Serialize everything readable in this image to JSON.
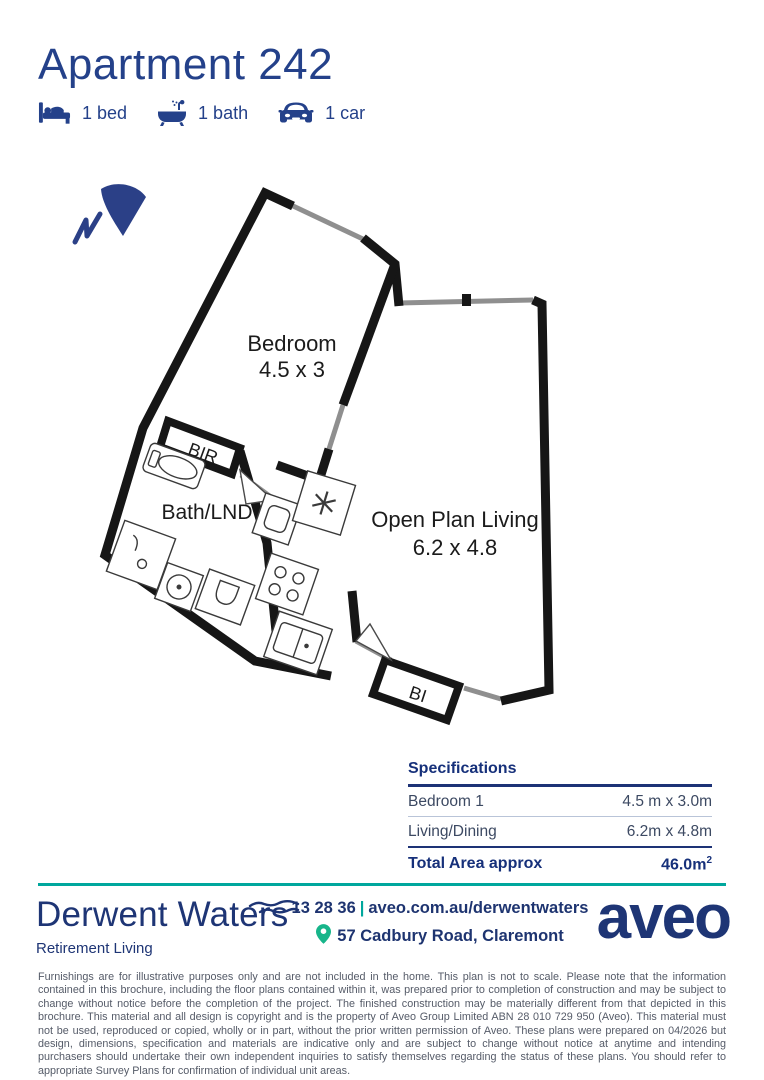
{
  "page": {
    "title": "Apartment 242"
  },
  "features": [
    {
      "icon": "bed-icon",
      "label": "1 bed"
    },
    {
      "icon": "bath-icon",
      "label": "1 bath"
    },
    {
      "icon": "car-icon",
      "label": "1 car"
    }
  ],
  "floorplan": {
    "north_icon": "north-arrow-icon",
    "bedroom": {
      "name": "Bedroom",
      "dims": "4.5 x 3"
    },
    "bath": {
      "name": "Bath/LND"
    },
    "living": {
      "name": "Open Plan Living",
      "dims": "6.2 x 4.8"
    },
    "robe_label": "BIR",
    "builtin_label": "BI",
    "wall_color": "#161616",
    "window_color": "#8f8f8f"
  },
  "specifications": {
    "heading": "Specifications",
    "rows": [
      {
        "label": "Bedroom 1",
        "value": "4.5 m x 3.0m"
      },
      {
        "label": "Living/Dining",
        "value": "6.2m x 4.8m"
      }
    ],
    "total": {
      "label": "Total Area approx",
      "value": "46.0m",
      "sup": "2"
    }
  },
  "footer": {
    "brand": "Derwent Waters",
    "brand_sub": "Retirement Living",
    "phone": "13 28 36",
    "separator": "|",
    "website": "aveo.com.au/derwentwaters",
    "address": "57 Cadbury Road, Claremont",
    "logo": "aveo",
    "wave_icon": "wave-icon",
    "pin_icon": "location-pin-icon"
  },
  "colors": {
    "navy": "#1e3575",
    "title_navy": "#24418a",
    "teal": "#00a79d",
    "pin_green": "#17b58a",
    "row_text": "#3c4962",
    "disclaimer_gray": "#555b68"
  },
  "disclaimer": "Furnishings are for illustrative purposes only and are not included in the home. This plan is not to scale. Please note that the information contained in this brochure, including the floor plans contained within it, was prepared prior to completion of construction and may be subject to change without notice before the completion of the project. The finished construction may be materially different from that depicted in this brochure. This material and all design is copyright and is the property of Aveo Group Limited ABN 28 010 729 950 (Aveo). This material must not be used, reproduced or copied, wholly or in part, without the prior written permission of Aveo. These plans were prepared on 04/2026 but design, dimensions, specification and materials are indicative only and are subject to change without notice at anytime and intending purchasers should undertake their own independent inquiries to satisfy themselves regarding the status of these plans. You should refer to appropriate Survey Plans for confirmation of individual unit areas."
}
